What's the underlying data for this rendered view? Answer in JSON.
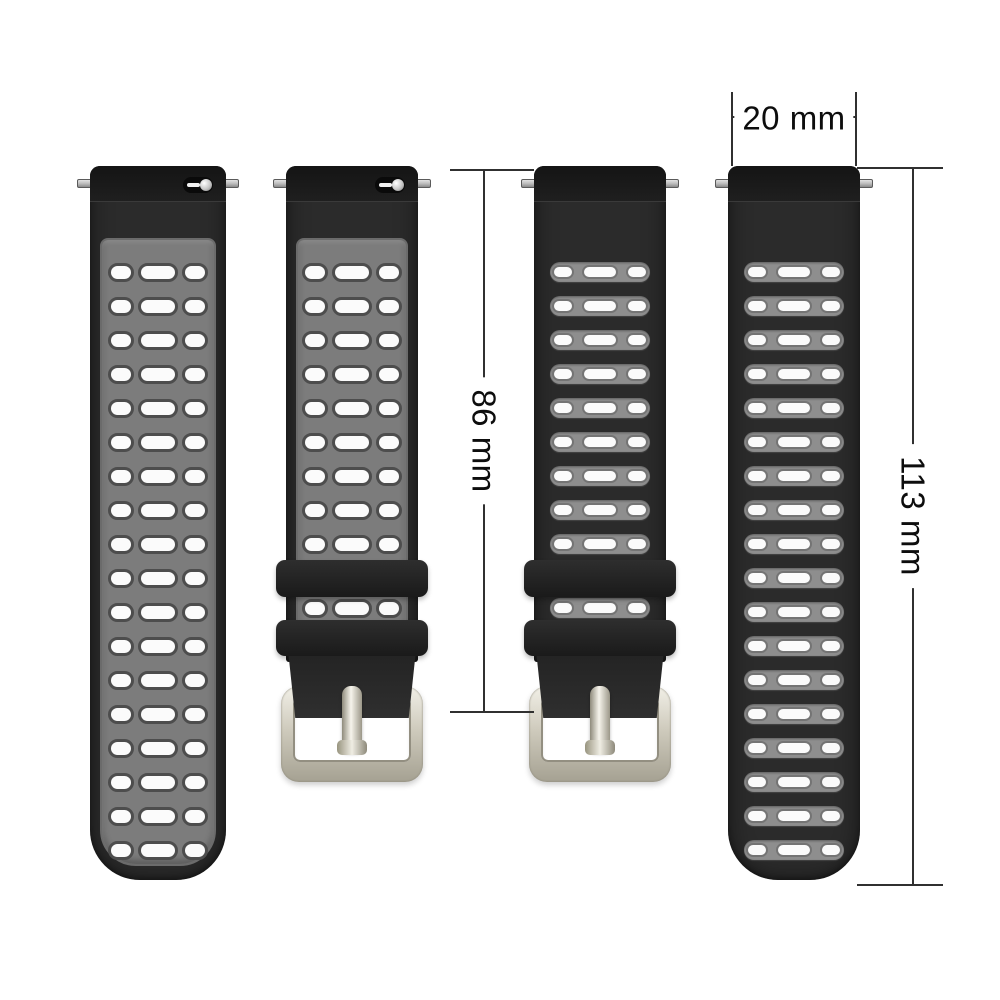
{
  "title": "Silicone watch strap dimension diagram",
  "annotations": {
    "width": {
      "label": "20 mm",
      "value_mm": 20
    },
    "buckle_strap_length": {
      "label": "86 mm",
      "value_mm": 86
    },
    "long_strap_length": {
      "label": "113 mm",
      "value_mm": 113
    }
  },
  "straps": [
    {
      "name": "strap-front-long",
      "view": "front",
      "type": "long",
      "hole_rows": 18,
      "keepers": 0,
      "inter_keeper_rows": 0,
      "has_buckle": false,
      "has_quick_release_slider": true,
      "has_spring_bar_pins": true
    },
    {
      "name": "strap-front-buckle",
      "view": "front",
      "type": "buckle",
      "hole_rows": 9,
      "keepers": 2,
      "inter_keeper_rows": 1,
      "has_buckle": true,
      "has_quick_release_slider": true,
      "has_spring_bar_pins": true
    },
    {
      "name": "strap-back-buckle",
      "view": "back",
      "type": "buckle",
      "hole_rows": 9,
      "keepers": 2,
      "inter_keeper_rows": 1,
      "has_buckle": true,
      "has_quick_release_slider": false,
      "has_spring_bar_pins": true
    },
    {
      "name": "strap-back-long",
      "view": "back",
      "type": "long",
      "hole_rows": 18,
      "keepers": 0,
      "inter_keeper_rows": 0,
      "has_buckle": false,
      "has_quick_release_slider": false,
      "has_spring_bar_pins": true
    }
  ],
  "colors": {
    "background": "#ffffff",
    "strap_black": "#2b2b2b",
    "strap_black_dark": "#141414",
    "panel_gray": "#7c7c7c",
    "band_gray": "#8e8e8e",
    "hole_white": "#fbfbfb",
    "hole_rim": "#4d4d4d",
    "keeper_black": "#1a1a1a",
    "buckle_silver_light": "#f2f0e8",
    "buckle_silver": "#cfcbbd",
    "buckle_silver_dark": "#a5a192",
    "pin_silver": "#b9b9b9",
    "dimension_line": "#303030",
    "text": "#0d0d0d"
  }
}
